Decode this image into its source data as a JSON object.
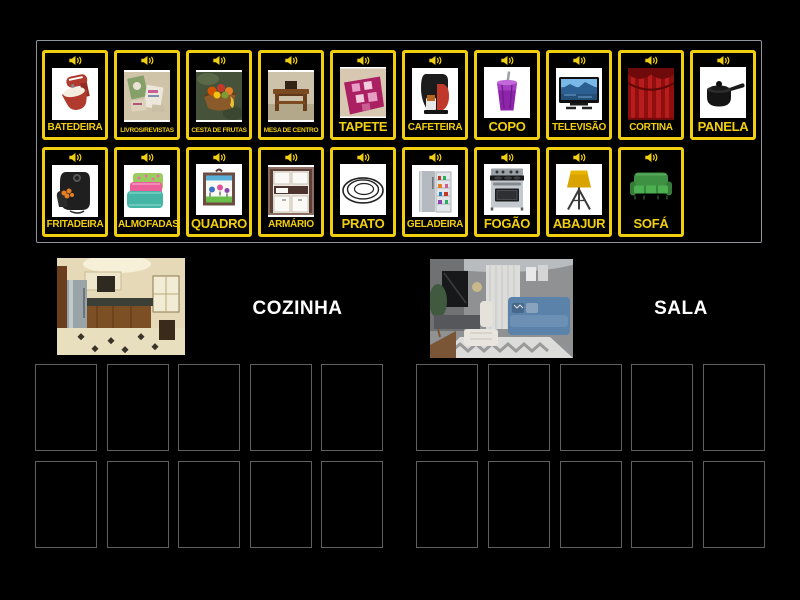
{
  "activity": {
    "name": "group-sort-board"
  },
  "colors": {
    "background": "#000000",
    "card_border": "#f2cf0e",
    "card_label": "#f2cf0e",
    "panel_border": "#8f969b",
    "slot_border": "#5e6164",
    "group_label": "#ffffff"
  },
  "cards": [
    {
      "label": "BATEDEIRA",
      "icon": "mixer-icon",
      "row": 1
    },
    {
      "label": "LIVROS/REVISTAS",
      "icon": "books-magazines-icon",
      "row": 1
    },
    {
      "label": "CESTA DE FRUTAS",
      "icon": "fruit-basket-icon",
      "row": 1
    },
    {
      "label": "MESA DE CENTRO",
      "icon": "coffee-table-icon",
      "row": 1
    },
    {
      "label": "TAPETE",
      "icon": "rug-icon",
      "row": 1
    },
    {
      "label": "CAFETEIRA",
      "icon": "coffee-machine-icon",
      "row": 1
    },
    {
      "label": "COPO",
      "icon": "cup-icon",
      "row": 1
    },
    {
      "label": "TELEVISÃO",
      "icon": "television-icon",
      "row": 1
    },
    {
      "label": "CORTINA",
      "icon": "curtain-icon",
      "row": 1
    },
    {
      "label": "PANELA",
      "icon": "saucepan-icon",
      "row": 1
    },
    {
      "label": "FRITADEIRA",
      "icon": "air-fryer-icon",
      "row": 2
    },
    {
      "label": "ALMOFADAS",
      "icon": "pillows-icon",
      "row": 2
    },
    {
      "label": "QUADRO",
      "icon": "picture-frame-icon",
      "row": 2
    },
    {
      "label": "ARMÁRIO",
      "icon": "cabinet-icon",
      "row": 2
    },
    {
      "label": "PRATO",
      "icon": "plate-icon",
      "row": 2
    },
    {
      "label": "GELADEIRA",
      "icon": "fridge-icon",
      "row": 2
    },
    {
      "label": "FOGÃO",
      "icon": "stove-icon",
      "row": 2
    },
    {
      "label": "ABAJUR",
      "icon": "lamp-icon",
      "row": 2
    },
    {
      "label": "SOFÁ",
      "icon": "sofa-icon",
      "row": 2
    }
  ],
  "groups": [
    {
      "label": "COZINHA",
      "image": "kitchen-photo",
      "slots": 10
    },
    {
      "label": "SALA",
      "image": "living-room-photo",
      "slots": 10
    }
  ]
}
